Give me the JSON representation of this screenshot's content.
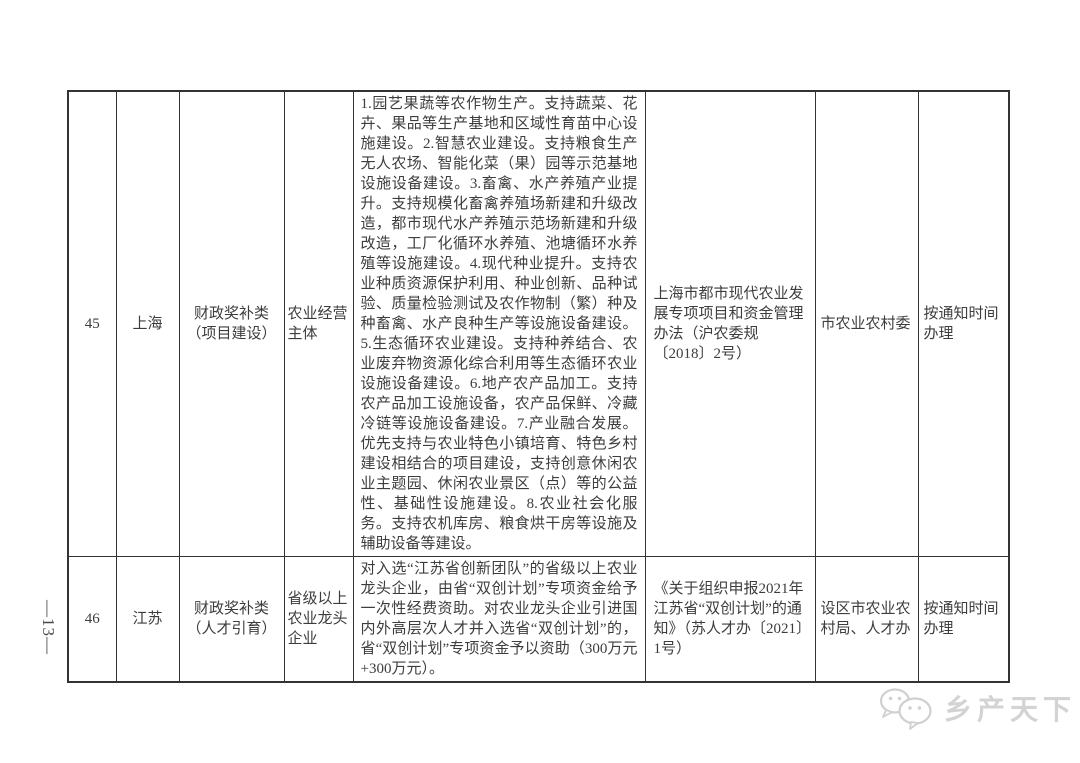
{
  "page": {
    "number_label": "—13—"
  },
  "watermark": {
    "text": "乡产天下",
    "icon": "wechat-chat-bubbles-icon",
    "color": "#d3d3d3"
  },
  "colors": {
    "text": "#3d3d3d",
    "border": "#333333",
    "background": "#ffffff",
    "watermark": "#d3d3d3"
  },
  "table": {
    "rows": [
      {
        "no": "45",
        "region": "上海",
        "category": "财政奖补类（项目建设）",
        "target": "农业经营主体",
        "measures": "1.园艺果蔬等农作物生产。支持蔬菜、花卉、果品等生产基地和区域性育苗中心设施建设。2.智慧农业建设。支持粮食生产无人农场、智能化菜（果）园等示范基地设施设备建设。3.畜禽、水产养殖产业提升。支持规模化畜禽养殖场新建和升级改造，都市现代水产养殖示范场新建和升级改造，工厂化循环水养殖、池塘循环水养殖等设施建设。4.现代种业提升。支持农业种质资源保护利用、种业创新、品种试验、质量检验测试及农作物制（繁）种及种畜禽、水产良种生产等设施设备建设。5.生态循环农业建设。支持种养结合、农业废弃物资源化综合利用等生态循环农业设施设备建设。6.地产农产品加工。支持农产品加工设施设备，农产品保鲜、冷藏冷链等设施设备建设。7.产业融合发展。优先支持与农业特色小镇培育、特色乡村建设相结合的项目建设，支持创意休闲农业主题园、休闲农业景区（点）等的公益性、基础性设施建设。8.农业社会化服务。支持农机库房、粮食烘干房等设施及辅助设备等建设。",
        "policy_basis": "上海市都市现代农业发展专项项目和资金管理办法（沪农委规〔2018〕2号）",
        "department": "市农业农村委",
        "schedule": "按通知时间办理"
      },
      {
        "no": "46",
        "region": "江苏",
        "category": "财政奖补类（人才引育）",
        "target": "省级以上农业龙头企业",
        "measures": "对入选“江苏省创新团队”的省级以上农业龙头企业，由省“双创计划”专项资金给予一次性经费资助。对农业龙头企业引进国内外高层次人才并入选省“双创计划”的，省“双创计划”专项资金予以资助（300万元+300万元）。",
        "policy_basis": "《关于组织申报2021年江苏省“双创计划”的通知》（苏人才办〔2021〕1号）",
        "department": "设区市农业农村局、人才办",
        "schedule": "按通知时间办理"
      }
    ]
  }
}
